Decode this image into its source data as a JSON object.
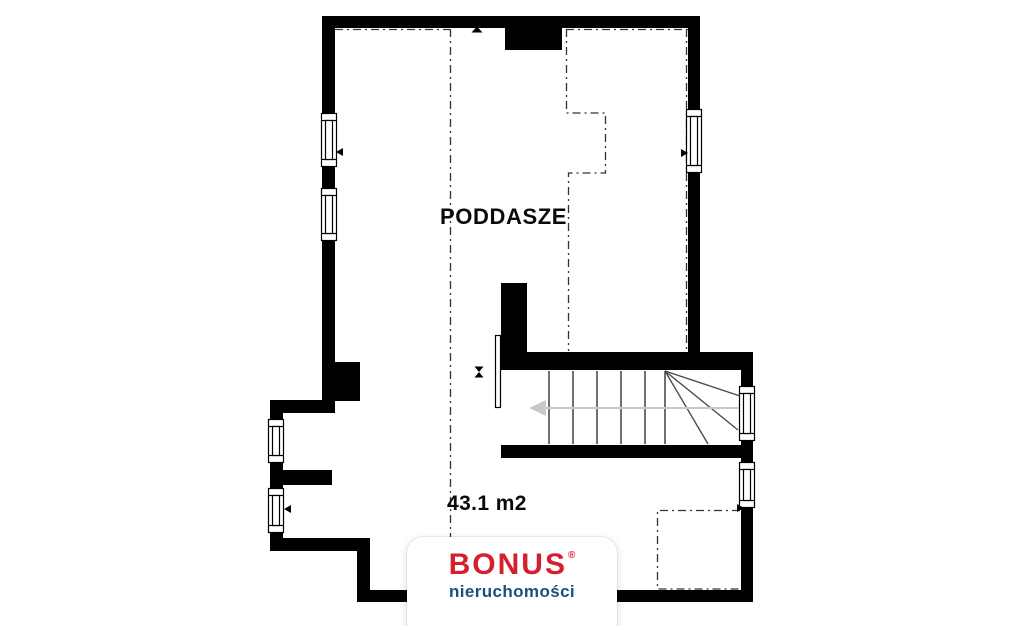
{
  "plan": {
    "room_label": "PODDASZE",
    "area_label": "43.1 m2"
  },
  "icons": {
    "stair_direction_arrow": "left-arrow",
    "door_pivot": "hourglass-bowtie",
    "window_handle_left": "triangle-left",
    "window_handle_right": "triangle-right",
    "top_wall_marker": "triangle-up"
  },
  "watermark": {
    "brand": "BONUS",
    "registered_mark": "®",
    "tagline": "nieruchomości",
    "brand_color": "#d51f2d",
    "tagline_color": "#1d4e7e",
    "card_background": "#ffffff"
  },
  "colors": {
    "walls": "#000000",
    "construction_lines": "#333333",
    "stair_treads": "#4d4d4d",
    "stair_arrow": "#c9c9c9",
    "background": "#ffffff"
  }
}
